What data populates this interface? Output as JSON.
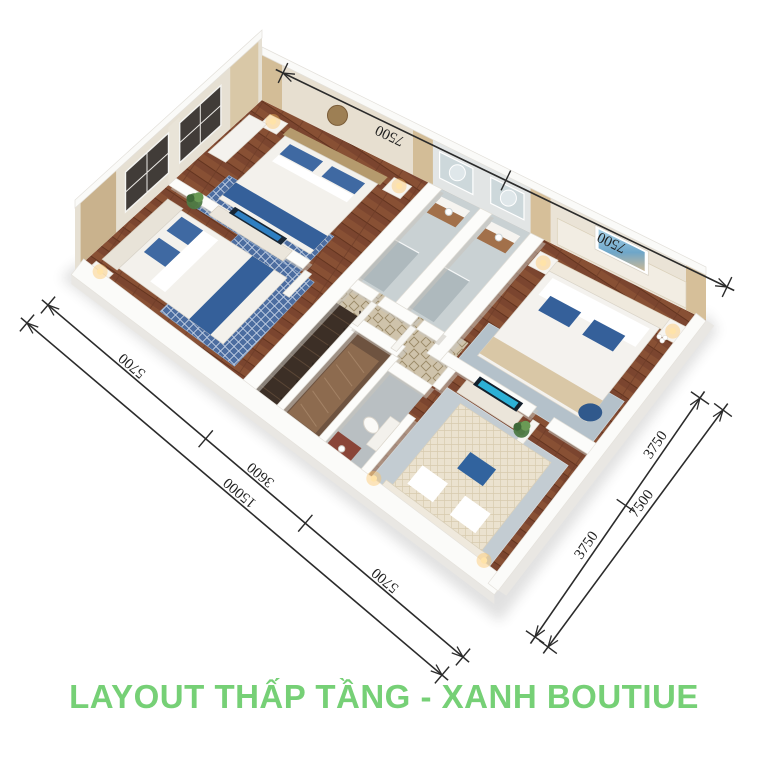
{
  "page": {
    "background": "#ffffff",
    "type": "3d-isometric-floor-plan-render"
  },
  "title": {
    "text": "LAYOUT THẤP TẦNG - XANH BOUTIUE",
    "color": "#76d076"
  },
  "dimensions": {
    "top": {
      "labels": [
        "7500",
        "7500"
      ]
    },
    "left": {
      "inner_labels": [
        "5700",
        "3600",
        "5700"
      ],
      "outer_label": "15000"
    },
    "right": {
      "inner_labels": [
        "3750",
        "3750"
      ],
      "outer_label": "7500"
    }
  },
  "scene": {
    "rooms": [
      "bedroom",
      "bedroom",
      "bathroom",
      "bathroom",
      "stair-hall",
      "walk-in-closet",
      "wc",
      "master-bedroom",
      "bedroom"
    ],
    "floor_material": "herringbone-wood",
    "palette": {
      "wood": "#7b452f",
      "wall_white": "#fbfbf9",
      "accent_blue": "#3f69a2",
      "dim_line": "#2b2b2b"
    }
  }
}
